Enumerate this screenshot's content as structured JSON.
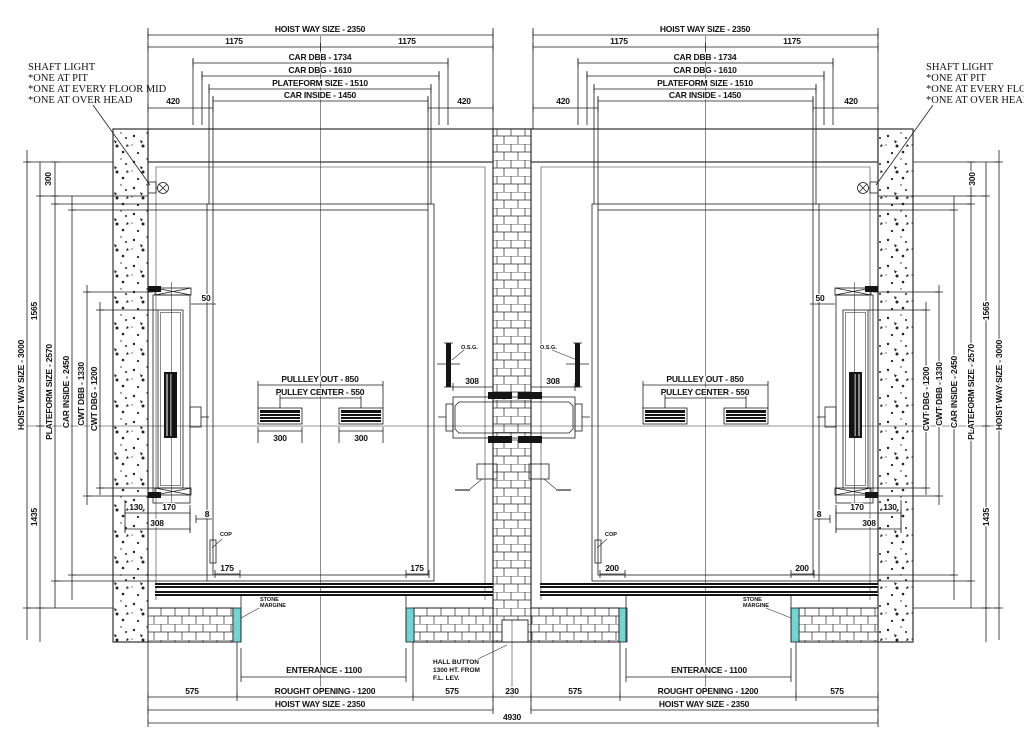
{
  "drawing": {
    "top": {
      "hoistway": "HOIST WAY SIZE - 2350",
      "half": "1175",
      "car_dbb": "CAR DBB - 1734",
      "car_dbg": "CAR DBG - 1610",
      "platform": "PLATEFORM SIZE - 1510",
      "car_inside": "CAR INSIDE - 1450",
      "offset": "420"
    },
    "side": {
      "d300": "300",
      "d1565": "1565",
      "hoistway": "HOIST WAY SIZE - 3000",
      "platform": "PLATEFORM SIZE - 2570",
      "car_inside": "CAR INSIDE - 2450",
      "cwt_dbb": "CWT DBB - 1330",
      "cwt_dbg": "CWT DBG - 1200",
      "d1435": "1435"
    },
    "cwt": {
      "d50": "50",
      "d130": "130",
      "d170": "170",
      "d308": "308",
      "d8": "8"
    },
    "machine": {
      "d308": "308",
      "osg": "O.S.G."
    },
    "pulley": {
      "out": "PULLLEY OUT - 850",
      "center": "PULLEY CENTER - 550",
      "d300": "300"
    },
    "doors": {
      "d175": "175",
      "d200": "200",
      "cop": "COP",
      "margin1": "STONE",
      "margin2": "MARGINE"
    },
    "bottom": {
      "enterance": "ENTERANCE - 1100",
      "d575": "575",
      "rough": "ROUGHT OPENING - 1200",
      "d230": "230",
      "hoistway": "HOIST WAY SIZE - 2350",
      "total": "4930"
    },
    "notes": {
      "shaft_light": [
        "SHAFT LIGHT",
        "*ONE AT PIT",
        "*ONE AT EVERY FLOOR MID",
        "*ONE AT OVER HEAD"
      ],
      "hall_button": [
        "HALL BUTTON",
        "1300 HT. FROM",
        "F.L. LEV."
      ]
    },
    "colors": {
      "line": "#1d1d1d",
      "stone_margin": "#74d4d4"
    }
  }
}
